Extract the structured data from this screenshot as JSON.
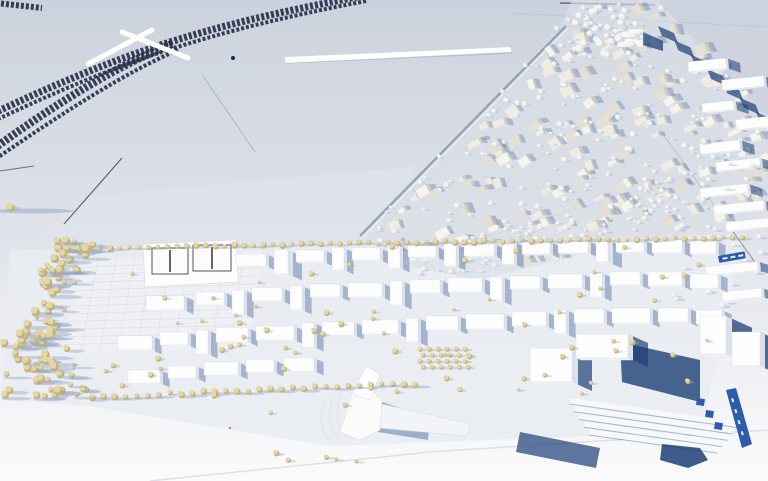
{
  "canvas": {
    "w": 768,
    "h": 481
  },
  "palette": {
    "ground_top": "#ccd2dd",
    "ground_mid": "#dde1e8",
    "ground_low": "#f0f1f4",
    "ground_bottom": "#fbfbfc",
    "plinth": "#e9ecf1",
    "patch_field": "#dfe3ea",
    "patch_ne": "#cdd3de",
    "shadow_strong": "#1d3f77",
    "shadow_mid": "#5f7bab",
    "shadow_soft": "#93a4c4",
    "track": "#202842",
    "bridge_white": "#ffffff",
    "white_top": "#fdfdfe",
    "white_side": "#dde2ea",
    "white_front": "#eef1f5",
    "edge_line": "#d0d6de",
    "old_top_a": "#efece4",
    "old_top_b": "#e4e0d5",
    "old_top_c": "#f6f4ee",
    "old_side": "#ccc9bf",
    "tree_beige": "#e3d7a8",
    "tree_beige_dark": "#c2b178",
    "tree_white": "#f3f4f3",
    "tree_white_dark": "#d8dbdd",
    "court_line": "#3a4254",
    "label_blue": "#2e5cab",
    "label_text": "#ffffff",
    "road_faint": "#aab3c4",
    "seam": "#d9dde3",
    "wall_shadow": "#9fadc6",
    "grid_line": "#d7dbe3"
  },
  "railway": {
    "main": "M 362,-4 C 300,8 240,20 170,42 C 100,64 30,96 -8,114",
    "main2": "M 366,1 C 304,13 244,26 174,48 C 104,70 34,102 -6,121",
    "branch": "M 172,44 C 120,64 58,102 -8,150",
    "branch2": "M 178,50 C 126,72 64,112 -6,160",
    "stub": "M -4,3 L 42,8",
    "top_line": "M 560,3 L 655,5",
    "bridges": [
      [
        88,
        64,
        152,
        30
      ],
      [
        122,
        32,
        188,
        58
      ]
    ],
    "dot": [
      233,
      58
    ]
  },
  "patches": [
    {
      "d": "M 90,196 L 420,166 L 362,236 L 14,252 Z",
      "c": "#dfe3ea",
      "o": 0.8
    },
    {
      "d": "M 655,0 L 768,0 L 768,118 Z",
      "c": "#cdd3de",
      "o": 0.9
    }
  ],
  "field_lines": [
    {
      "d": "M 512,13 L 768,27",
      "c": "#bfc6d1",
      "w": 1,
      "o": 0.8
    },
    {
      "d": "M 255,152 L 203,76",
      "c": "#9aa4b4",
      "w": 1,
      "o": 0.7
    },
    {
      "d": "M 122,158 L 64,224",
      "c": "#49536e",
      "w": 1.2,
      "o": 0.9
    },
    {
      "d": "M 0,171 L 34,166",
      "c": "#49536e",
      "w": 1,
      "o": 0.8
    },
    {
      "d": "M 585,22 L 382,228",
      "c": "#c2c8d3",
      "w": 1,
      "o": 0.7
    },
    {
      "d": "M 660,130 L 762,272",
      "c": "#44507a",
      "w": 1,
      "o": 0.6
    },
    {
      "d": "M 400,262 L 700,172",
      "c": "#aab3c4",
      "w": 1,
      "o": 0.7
    },
    {
      "d": "M 150,481 L 430,452 L 768,430",
      "c": "#d9dde3",
      "w": 1.5,
      "o": 0.9
    }
  ],
  "wall_strip": {
    "d": "M 284,57 L 510,47 L 512,52 L 286,63 Z",
    "shadow": "M 286,63 L 512,53"
  },
  "old_town": {
    "outline": [
      [
        362,
        234
      ],
      [
        560,
        28
      ],
      [
        572,
        0
      ],
      [
        658,
        0
      ],
      [
        768,
        120
      ],
      [
        768,
        208
      ],
      [
        700,
        234
      ],
      [
        600,
        250
      ],
      [
        478,
        280
      ],
      [
        418,
        268
      ]
    ],
    "seed": 11,
    "buildings": 160,
    "trees": 170,
    "edge_road": "M 360,236 L 566,26",
    "edge_shadow_line": [
      [
        658,
        26
      ],
      [
        756,
        112
      ]
    ],
    "edge_shadow_n": 7,
    "church": {
      "x": 617,
      "y": 29,
      "w": 26,
      "h": 18
    }
  },
  "woods": {
    "cx": 598,
    "cy": 30,
    "rx": 46,
    "ry": 27,
    "n": 46,
    "seed": 5
  },
  "suburb": {
    "slabs": [
      [
        688,
        60,
        38,
        10
      ],
      [
        722,
        78,
        42,
        10
      ],
      [
        702,
        102,
        32,
        9
      ],
      [
        736,
        118,
        34,
        10
      ],
      [
        700,
        142,
        40,
        10
      ],
      [
        716,
        160,
        44,
        9
      ],
      [
        700,
        186,
        48,
        9
      ],
      [
        714,
        203,
        50,
        9
      ],
      [
        726,
        220,
        46,
        9
      ],
      [
        706,
        264,
        52,
        9
      ],
      [
        722,
        290,
        40,
        9
      ]
    ],
    "tree_poly": [
      [
        640,
        150
      ],
      [
        768,
        128
      ],
      [
        768,
        310
      ],
      [
        660,
        300
      ]
    ],
    "trees": 30,
    "seed": 9
  },
  "avenue": {
    "poly": [
      [
        398,
        258
      ],
      [
        700,
        168
      ],
      [
        718,
        198
      ],
      [
        428,
        288
      ]
    ],
    "n": 110,
    "seed": 3
  },
  "development": {
    "plinth": [
      [
        10,
        250
      ],
      [
        745,
        234
      ],
      [
        700,
        432
      ],
      [
        330,
        446
      ],
      [
        90,
        406
      ],
      [
        0,
        400
      ]
    ],
    "plaza": {
      "a": [
        80,
        260
      ],
      "b": [
        262,
        251
      ],
      "c": [
        248,
        350
      ],
      "dd": [
        62,
        352
      ],
      "nv": 12,
      "nh": 10
    },
    "court_platform": "M 143,244 L 236,240 L 238,282 L 145,287 Z",
    "courts": [
      [
        152,
        248,
        36,
        26
      ],
      [
        193,
        245,
        38,
        26
      ]
    ],
    "blocks": [
      [
        236,
        254,
        30,
        12
      ],
      [
        274,
        250,
        14,
        24,
        5
      ],
      [
        296,
        250,
        28,
        12
      ],
      [
        332,
        248,
        12,
        22
      ],
      [
        352,
        248,
        28,
        12
      ],
      [
        388,
        246,
        12,
        22
      ],
      [
        408,
        246,
        28,
        11
      ],
      [
        444,
        244,
        12,
        22
      ],
      [
        464,
        244,
        30,
        12
      ],
      [
        502,
        242,
        12,
        22
      ],
      [
        522,
        242,
        28,
        12
      ],
      [
        558,
        241,
        30,
        12
      ],
      [
        596,
        240,
        12,
        22,
        5
      ],
      [
        616,
        240,
        28,
        12
      ],
      [
        652,
        240,
        30,
        13
      ],
      [
        690,
        241,
        26,
        13
      ],
      [
        146,
        296,
        38,
        14
      ],
      [
        196,
        292,
        28,
        13
      ],
      [
        232,
        290,
        12,
        24
      ],
      [
        252,
        288,
        30,
        13
      ],
      [
        290,
        286,
        12,
        24
      ],
      [
        310,
        284,
        30,
        13
      ],
      [
        348,
        283,
        34,
        14
      ],
      [
        390,
        281,
        12,
        24
      ],
      [
        410,
        280,
        30,
        13
      ],
      [
        448,
        278,
        34,
        14
      ],
      [
        490,
        277,
        12,
        24
      ],
      [
        510,
        276,
        30,
        13
      ],
      [
        548,
        274,
        34,
        14
      ],
      [
        590,
        273,
        12,
        24
      ],
      [
        610,
        272,
        30,
        13
      ],
      [
        648,
        272,
        34,
        14
      ],
      [
        690,
        274,
        28,
        14
      ],
      [
        118,
        336,
        34,
        14
      ],
      [
        160,
        332,
        28,
        13
      ],
      [
        196,
        330,
        12,
        24
      ],
      [
        216,
        328,
        32,
        14
      ],
      [
        256,
        326,
        38,
        14
      ],
      [
        302,
        323,
        12,
        24
      ],
      [
        322,
        322,
        32,
        13
      ],
      [
        362,
        320,
        36,
        14
      ],
      [
        406,
        318,
        12,
        24
      ],
      [
        426,
        316,
        32,
        14
      ],
      [
        466,
        314,
        38,
        15
      ],
      [
        512,
        312,
        34,
        14
      ],
      [
        554,
        310,
        12,
        24
      ],
      [
        574,
        309,
        30,
        14
      ],
      [
        612,
        308,
        38,
        15
      ],
      [
        658,
        308,
        30,
        14
      ],
      [
        696,
        310,
        26,
        14
      ],
      [
        128,
        370,
        32,
        13
      ],
      [
        168,
        366,
        28,
        12
      ],
      [
        204,
        362,
        34,
        13
      ],
      [
        246,
        360,
        28,
        12
      ],
      [
        284,
        358,
        30,
        13
      ]
    ],
    "scatter_poly": [
      [
        125,
        252
      ],
      [
        738,
        238
      ],
      [
        696,
        396
      ],
      [
        430,
        398
      ],
      [
        300,
        418
      ],
      [
        95,
        400
      ]
    ],
    "scatter_n": 70,
    "scatter_seed": 21,
    "top_row": {
      "x1": 62,
      "y1": 248,
      "x2": 742,
      "y2": 237,
      "n": 72
    },
    "bottom_row": {
      "x1": 92,
      "y1": 397,
      "x2": 415,
      "y2": 383,
      "n": 30
    },
    "park_a": {
      "poly": [
        [
          55,
          234
        ],
        [
          95,
          240
        ],
        [
          50,
          352
        ],
        [
          12,
          348
        ]
      ],
      "n": 60,
      "seed": 13
    },
    "park_b": {
      "poly": [
        [
          0,
          330
        ],
        [
          60,
          334
        ],
        [
          92,
          396
        ],
        [
          0,
          398
        ]
      ],
      "n": 40,
      "seed": 14
    },
    "orchard": {
      "x": 420,
      "y": 349,
      "cols": 6,
      "rows": 4,
      "dx": 9,
      "dy": 6
    },
    "contours": [
      "M 326,400 C 318,418 320,432 332,442",
      "M 334,396 C 326,414 328,430 340,440",
      "M 342,392 C 334,412 336,428 348,438"
    ],
    "wedge": {
      "base": "M 340,432 L 352,394 L 368,388 L 382,400 L 380,430 L 360,440 Z",
      "tower": "M 352,394 L 366,366 L 380,374 L 370,400 Z",
      "ramp": "M 382,404 L 470,424 L 466,436 L 378,428 Z",
      "shadow": "M 382,402 L 430,418 L 428,440 L 378,432 Z"
    },
    "hall": {
      "blocks": [
        [
          530,
          348,
          42,
          34,
          6
        ],
        [
          576,
          334,
          52,
          24,
          5
        ]
      ],
      "shadow": "M 620,342 L 700,360 L 700,402 L 622,382 Z"
    },
    "terraces": {
      "x": 570,
      "y": 398,
      "n": 5,
      "len": 170,
      "step": 7,
      "rot": 8
    },
    "right_blocks": [
      [
        700,
        316,
        26,
        38,
        6
      ],
      [
        732,
        332,
        28,
        34,
        5
      ]
    ],
    "blue_small": {
      "x": 718,
      "y": 256,
      "w": 27,
      "h": 7,
      "rot": -10
    },
    "blue_panels": [
      [
        697,
        398
      ],
      [
        706,
        410
      ],
      [
        715,
        422
      ]
    ],
    "blue_band": "M 726,390 L 736,388 L 752,444 L 742,448 Z",
    "big_shadow2": "M 520,432 L 600,448 L 596,468 L 516,452 Z",
    "blob": "M 662,444 L 700,448 L 708,460 L 688,468 L 660,460 Z"
  },
  "foreground": {
    "trees": [
      [
        276,
        453,
        3
      ],
      [
        288,
        460,
        2.5
      ],
      [
        326,
        457,
        2.5
      ],
      [
        336,
        459,
        2
      ],
      [
        356,
        461,
        2
      ]
    ],
    "speck": [
      230,
      428
    ],
    "lone_tree": {
      "x": 10,
      "y": 207,
      "r": 4,
      "shadow_len": 40
    }
  }
}
